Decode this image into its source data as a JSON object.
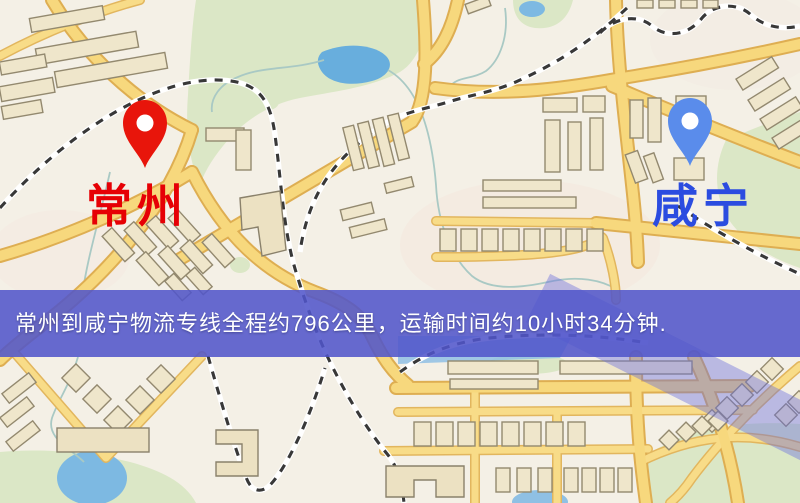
{
  "map": {
    "origin": {
      "name": "常州",
      "pin_color": "#e8150b",
      "label_color": "#e60005"
    },
    "destination": {
      "name": "咸宁",
      "pin_color": "#5a8ceb",
      "label_color": "#2b4ce0"
    },
    "banner": {
      "text": "常州到咸宁物流专线全程约796公里，运输时间约10小时34分钟.",
      "distance_km": "796",
      "duration": "10小时34分钟",
      "bg_color": "rgba(80,85,202,0.87)",
      "text_color": "#ffffff"
    },
    "palette": {
      "background": "#f4f0e6",
      "road_fill": "#f7d87d",
      "road_casing": "#deae52",
      "park_green": "#dbe7c6",
      "water_blue": "#68aedd",
      "building_fill": "#efe6cb",
      "railway_dark": "#383838",
      "expressway_tint": "rgba(106,110,222,0.42)"
    }
  }
}
